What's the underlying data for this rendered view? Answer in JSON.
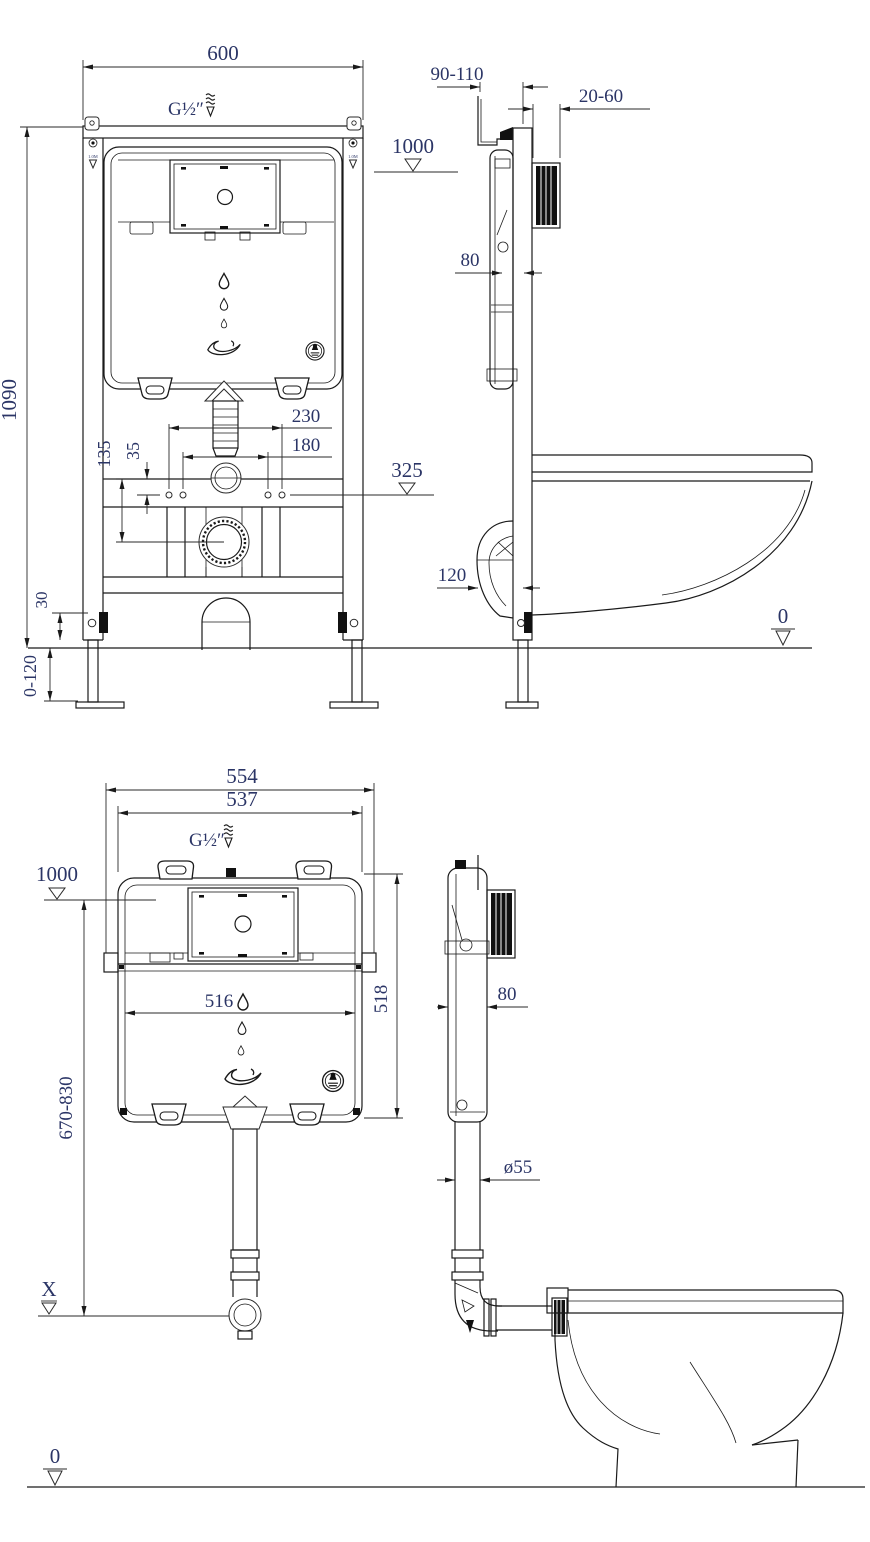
{
  "title": "Concealed cistern installation drawing",
  "colors": {
    "background": "#ffffff",
    "line": "#1a1a1a",
    "dim_text": "#2b3566"
  },
  "top": {
    "dim_600": "600",
    "supply": "G½″",
    "level_1000": "1000",
    "dim_90_110": "90-110",
    "dim_20_60": "20-60",
    "dim_80": "80",
    "dim_1090": "1090",
    "dim_230": "230",
    "dim_180": "180",
    "dim_135": "135",
    "dim_35": "35",
    "level_325": "325",
    "dim_120": "120",
    "dim_30": "30",
    "dim_0_120": "0-120",
    "level_0": "0",
    "rail_marker": "1.0M"
  },
  "bottom": {
    "dim_554": "554",
    "dim_537": "537",
    "supply": "G½″",
    "level_1000": "1000",
    "dim_516": "516",
    "dim_518": "518",
    "dim_670_830": "670-830",
    "dim_80": "80",
    "dim_d55": "ø55",
    "level_x": "X",
    "level_0": "0"
  }
}
